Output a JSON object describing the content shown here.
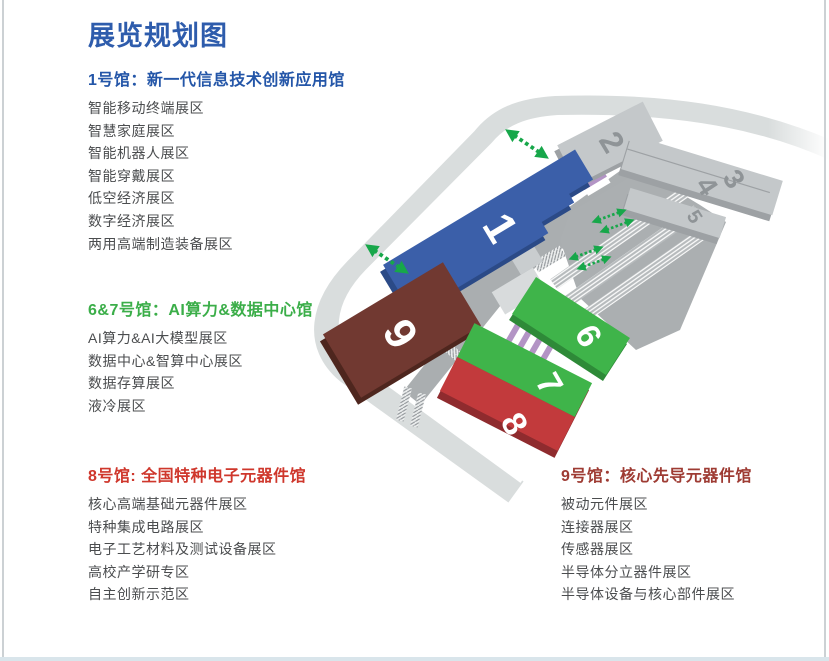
{
  "page": {
    "title": "展览规划图",
    "colors": {
      "title": "#2e5cac",
      "body_text": "#4b4d4f",
      "bottom_bar": "#d9e5eb",
      "side_border": "#ccd1d4"
    }
  },
  "sections": [
    {
      "header": "1号馆：新一代信息技术创新应用馆",
      "color": "#2456a8",
      "items": [
        "智能移动终端展区",
        "智慧家庭展区",
        "智能机器人展区",
        "智能穿戴展区",
        "低空经济展区",
        "数字经济展区",
        "两用高端制造装备展区"
      ]
    },
    {
      "header": "6&7号馆：AI算力&数据中心馆",
      "color": "#3bae49",
      "items": [
        "AI算力&AI大模型展区",
        "数据中心&智算中心展区",
        "数据存算展区",
        "液冷展区"
      ]
    },
    {
      "header": "8号馆: 全国特种电子元器件馆",
      "color": "#cf372c",
      "items": [
        "核心高端基础元器件展区",
        "特种集成电路展区",
        "电子工艺材料及测试设备展区",
        "高校产学研专区",
        "自主创新示范区"
      ]
    },
    {
      "header": "9号馆：核心先导元器件馆",
      "color": "#9e3b33",
      "items": [
        "被动元件展区",
        "连接器展区",
        "传感器展区",
        "半导体分立器件展区",
        "半导体设备与核心部件展区"
      ]
    }
  ],
  "map": {
    "halls": [
      {
        "number": "1",
        "color": "#3b5fa9",
        "side": "#2b4a87",
        "label_color": "#ffffff"
      },
      {
        "number": "2",
        "color": "#c4c8ca",
        "side": "#9da1a4",
        "label_color": "#8f9497"
      },
      {
        "number": "3",
        "color": "#c4c8ca",
        "side": "#9da1a4",
        "label_color": "#8f9497"
      },
      {
        "number": "4",
        "color": "#c4c8ca",
        "side": "#9da1a4",
        "label_color": "#8f9497"
      },
      {
        "number": "5",
        "color": "#c4c8ca",
        "side": "#9da1a4",
        "label_color": "#8f9497"
      },
      {
        "number": "6",
        "color": "#3fb44a",
        "side": "#2e8a38",
        "label_color": "#ffffff"
      },
      {
        "number": "7",
        "color": "#3fb44a",
        "side": "#2e8a38",
        "label_color": "#ffffff"
      },
      {
        "number": "8",
        "color": "#c23a3c",
        "side": "#8f2b2e",
        "label_color": "#ffffff"
      },
      {
        "number": "9",
        "color": "#713931",
        "side": "#4e261e",
        "label_color": "#ffffff"
      }
    ],
    "entrance_arrow_color": "#17a74a",
    "connector_stripe_color": "#b394c5",
    "road_outer_color": "#d9dddd",
    "road_inner_color": "#aaaeb0"
  }
}
